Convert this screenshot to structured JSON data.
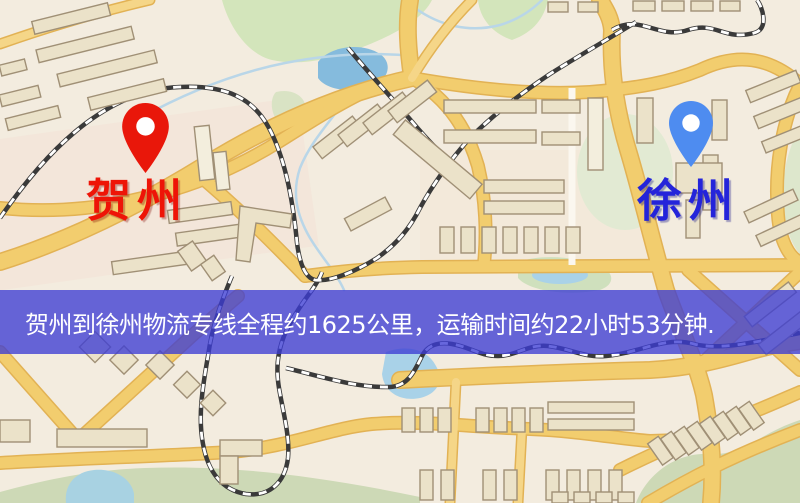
{
  "map": {
    "origin": {
      "label": "贺州",
      "pin_color": "#e9170a",
      "label_color": "#ee1407"
    },
    "destination": {
      "label": "徐州",
      "pin_color": "#4e8cf0",
      "label_color": "#2424da"
    },
    "banner": {
      "text": "贺州到徐州物流专线全程约1625公里，运输时间约22小时53分钟.",
      "background": "rgba(60,60,211,0.78)",
      "text_color": "#ffffff"
    },
    "palette": {
      "map_background": "#f3ecdf",
      "road_fill": "#f2cd6e",
      "road_casing": "#e2b254",
      "minor_road": "#fbf7ef",
      "building_fill": "#ebe2c9",
      "building_outline": "#a09076",
      "park_green": "#d3e5bb",
      "sage_green": "#cdd9b6",
      "water_blue": "#8fc3e2",
      "railway_dark": "#3a3a3a",
      "railway_light": "#ffffff"
    }
  }
}
